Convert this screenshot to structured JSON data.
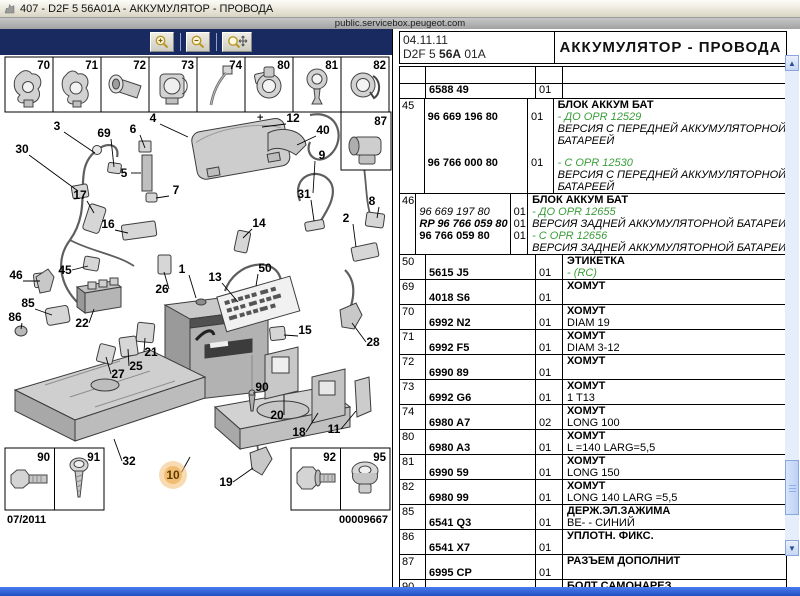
{
  "window": {
    "title": "407 - D2F 5 56A01A - АККУМУЛЯТОР - ПРОВОДА",
    "url": "public.servicebox.peugeot.com"
  },
  "toolbar": {
    "buttons": [
      {
        "name": "zoom-in"
      },
      {
        "name": "zoom-out"
      },
      {
        "name": "zoom-pan"
      }
    ]
  },
  "header": {
    "date": "04.11.11",
    "code_pre": "D2F 5 ",
    "code_mid": "56A",
    "code_suf": " 01A",
    "title": "АККУМУЛЯТОР - ПРОВОДА"
  },
  "colors": {
    "toolbar_navy": "#182a60",
    "note_green": "#3a9d3a",
    "highlight_orange": "#f2bd72",
    "taskbar_blue": "#2f5fd0",
    "panel_blue": "#dce6f5"
  },
  "diagram": {
    "top_cells": [
      "70",
      "71",
      "72",
      "73",
      "74",
      "80",
      "81",
      "82"
    ],
    "inset_87_label": "87",
    "inset_bl_labels": [
      "90",
      "91"
    ],
    "inset_br_labels": [
      "92",
      "95"
    ],
    "footer_left": "07/2011",
    "footer_right": "00009667",
    "highlight_callout": "10",
    "battery_plus_sign": "+",
    "callouts": [
      {
        "n": "3",
        "x": 57,
        "y": 74,
        "lx": 95,
        "ly": 98
      },
      {
        "n": "30",
        "x": 22,
        "y": 97,
        "lx": 78,
        "ly": 136
      },
      {
        "n": "69",
        "x": 104,
        "y": 81,
        "lx": 114,
        "ly": 112
      },
      {
        "n": "6",
        "x": 133,
        "y": 77,
        "lx": 145,
        "ly": 93
      },
      {
        "n": "4",
        "x": 153,
        "y": 66,
        "lx": 188,
        "ly": 82
      },
      {
        "n": "12",
        "x": 293,
        "y": 66,
        "lx": 262,
        "ly": 72
      },
      {
        "n": "40",
        "x": 323,
        "y": 78,
        "lx": 297,
        "ly": 90
      },
      {
        "n": "9",
        "x": 322,
        "y": 103,
        "lx": 313,
        "ly": 138
      },
      {
        "n": "5",
        "x": 124,
        "y": 121,
        "lx": 141,
        "ly": 118
      },
      {
        "n": "7",
        "x": 176,
        "y": 138,
        "lx": 156,
        "ly": 143
      },
      {
        "n": "17",
        "x": 80,
        "y": 143,
        "lx": 94,
        "ly": 158
      },
      {
        "n": "31",
        "x": 304,
        "y": 142,
        "lx": 314,
        "ly": 166
      },
      {
        "n": "8",
        "x": 372,
        "y": 149,
        "lx": 377,
        "ly": 163
      },
      {
        "n": "2",
        "x": 346,
        "y": 166,
        "lx": 356,
        "ly": 192
      },
      {
        "n": "16",
        "x": 108,
        "y": 172,
        "lx": 128,
        "ly": 178
      },
      {
        "n": "14",
        "x": 259,
        "y": 171,
        "lx": 243,
        "ly": 183
      },
      {
        "n": "46",
        "x": 16,
        "y": 223,
        "lx": 40,
        "ly": 226
      },
      {
        "n": "45",
        "x": 65,
        "y": 218,
        "lx": 88,
        "ly": 211
      },
      {
        "n": "1",
        "x": 182,
        "y": 217,
        "lx": 196,
        "ly": 243
      },
      {
        "n": "13",
        "x": 215,
        "y": 225,
        "lx": 238,
        "ly": 247
      },
      {
        "n": "50",
        "x": 265,
        "y": 216,
        "lx": 256,
        "ly": 231
      },
      {
        "n": "26",
        "x": 162,
        "y": 237,
        "lx": 164,
        "ly": 217
      },
      {
        "n": "85",
        "x": 28,
        "y": 251,
        "lx": 52,
        "ly": 260
      },
      {
        "n": "86",
        "x": 15,
        "y": 265,
        "lx": 21,
        "ly": 274
      },
      {
        "n": "22",
        "x": 82,
        "y": 271,
        "lx": 94,
        "ly": 254
      },
      {
        "n": "21",
        "x": 151,
        "y": 300,
        "lx": 145,
        "ly": 283
      },
      {
        "n": "25",
        "x": 136,
        "y": 314,
        "lx": 128,
        "ly": 294
      },
      {
        "n": "27",
        "x": 118,
        "y": 322,
        "lx": 106,
        "ly": 302
      },
      {
        "n": "15",
        "x": 305,
        "y": 278,
        "lx": 284,
        "ly": 280
      },
      {
        "n": "28",
        "x": 373,
        "y": 290,
        "lx": 352,
        "ly": 268
      },
      {
        "n": "90",
        "x": 262,
        "y": 335,
        "lx": 253,
        "ly": 338
      },
      {
        "n": "20",
        "x": 277,
        "y": 363,
        "lx": 284,
        "ly": 340
      },
      {
        "n": "18",
        "x": 299,
        "y": 380,
        "lx": 318,
        "ly": 358
      },
      {
        "n": "11",
        "x": 334,
        "y": 377,
        "lx": 356,
        "ly": 356
      },
      {
        "n": "32",
        "x": 129,
        "y": 409,
        "lx": 114,
        "ly": 384
      },
      {
        "n": "10",
        "x": 173,
        "y": 423,
        "lx": 190,
        "ly": 402,
        "hl": true
      },
      {
        "n": "19",
        "x": 226,
        "y": 430,
        "lx": 253,
        "ly": 413
      }
    ]
  },
  "table": {
    "rows": [
      {
        "ref": "",
        "h": 16,
        "lines": []
      },
      {
        "ref": "",
        "h": 14,
        "lines": [
          {
            "p": "6588 49",
            "ps": "b",
            "q": "01"
          }
        ]
      },
      {
        "ref": "45",
        "lines": [
          {
            "d": "БЛОК АККУМ БАТ",
            "ds": "t"
          },
          {
            "p": "96 669 196 80",
            "ps": "b",
            "q": "01",
            "d": "- ДО OPR 12529",
            "ds": "g"
          },
          {
            "d": "ВЕРСИЯ С ПЕРЕДНЕЙ АККУМУЛЯТОРНОЙ",
            "ds": "i"
          },
          {
            "d": "БАТАРЕЕЙ",
            "ds": "i"
          },
          {
            "gap": true,
            "gh": 10
          },
          {
            "p": "96 766 000 80",
            "ps": "b",
            "q": "01",
            "d": "- С OPR 12530",
            "ds": "g"
          },
          {
            "d": "ВЕРСИЯ С ПЕРЕДНЕЙ АККУМУЛЯТОРНОЙ",
            "ds": "i"
          },
          {
            "d": "БАТАРЕЕЙ",
            "ds": "i"
          }
        ]
      },
      {
        "ref": "46",
        "lines": [
          {
            "d": "БЛОК АККУМ БАТ",
            "ds": "t"
          },
          {
            "p": "96 669 197 80",
            "ps": "i",
            "q": "01",
            "d": "- ДО OPR 12655",
            "ds": "g"
          },
          {
            "p": "RP 96 766 059 80",
            "ps": "bir",
            "q": "01",
            "d": "ВЕРСИЯ ЗАДНЕЙ АККУМУЛЯТОРНОЙ БАТАРЕИ",
            "ds": "i"
          },
          {
            "p": "96 766 059 80",
            "ps": "b",
            "q": "01",
            "d": "- С OPR 12656",
            "ds": "g"
          },
          {
            "d": "ВЕРСИЯ ЗАДНЕЙ АККУМУЛЯТОРНОЙ БАТАРЕИ",
            "ds": "i"
          }
        ]
      },
      {
        "ref": "50",
        "lines": [
          {
            "d": "ЭТИКЕТКА",
            "ds": "t"
          },
          {
            "p": "5615 J5",
            "ps": "b",
            "q": "01",
            "d": "- (RC)",
            "ds": "g"
          }
        ]
      },
      {
        "ref": "69",
        "lines": [
          {
            "d": "ХОМУТ",
            "ds": "t"
          },
          {
            "p": "4018 S6",
            "ps": "b",
            "q": "01"
          }
        ]
      },
      {
        "ref": "70",
        "lines": [
          {
            "d": "ХОМУТ",
            "ds": "t"
          },
          {
            "p": "6992 N2",
            "ps": "b",
            "q": "01",
            "d": "DIAM 19"
          }
        ]
      },
      {
        "ref": "71",
        "lines": [
          {
            "d": "ХОМУТ",
            "ds": "t"
          },
          {
            "p": "6992 F5",
            "ps": "b",
            "q": "01",
            "d": "DIAM 3-12"
          }
        ]
      },
      {
        "ref": "72",
        "lines": [
          {
            "d": "ХОМУТ",
            "ds": "t"
          },
          {
            "p": "6990 89",
            "ps": "b",
            "q": "01"
          }
        ]
      },
      {
        "ref": "73",
        "lines": [
          {
            "d": "ХОМУТ",
            "ds": "t"
          },
          {
            "p": "6992 G6",
            "ps": "b",
            "q": "01",
            "d": "1 T13"
          }
        ]
      },
      {
        "ref": "74",
        "lines": [
          {
            "d": "ХОМУТ",
            "ds": "t"
          },
          {
            "p": "6980 A7",
            "ps": "b",
            "q": "02",
            "d": "LONG 100"
          }
        ]
      },
      {
        "ref": "80",
        "lines": [
          {
            "d": "ХОМУТ",
            "ds": "t"
          },
          {
            "p": "6980 A3",
            "ps": "b",
            "q": "01",
            "d": "L =140 LARG=5,5"
          }
        ]
      },
      {
        "ref": "81",
        "lines": [
          {
            "d": "ХОМУТ",
            "ds": "t"
          },
          {
            "p": "6990 59",
            "ps": "b",
            "q": "01",
            "d": "LONG 150"
          }
        ]
      },
      {
        "ref": "82",
        "lines": [
          {
            "d": "ХОМУТ",
            "ds": "t"
          },
          {
            "p": "6980 99",
            "ps": "b",
            "q": "01",
            "d": "LONG 140 LARG =5,5"
          }
        ]
      },
      {
        "ref": "85",
        "lines": [
          {
            "d": "ДЕРЖ.ЭЛ.ЗАЖИМА",
            "ds": "t"
          },
          {
            "p": "6541 Q3",
            "ps": "b",
            "q": "01",
            "d": "BE- - СИНИЙ"
          }
        ]
      },
      {
        "ref": "86",
        "lines": [
          {
            "d": "УПЛОТН. ФИКС.",
            "ds": "t"
          },
          {
            "p": "6541 X7",
            "ps": "b",
            "q": "01"
          }
        ]
      },
      {
        "ref": "87",
        "lines": [
          {
            "d": "РАЗЪЕМ ДОПОЛНИТ",
            "ds": "t"
          },
          {
            "p": "6995 CP",
            "ps": "b",
            "q": "01"
          }
        ]
      },
      {
        "ref": "90",
        "lines": [
          {
            "d": "БОЛТ САМОНАРЕЗ.",
            "ds": "t"
          },
          {
            "p": "6923 54",
            "ps": "b",
            "q": "02",
            "d": "DIAM 6X100 20"
          }
        ]
      }
    ]
  }
}
